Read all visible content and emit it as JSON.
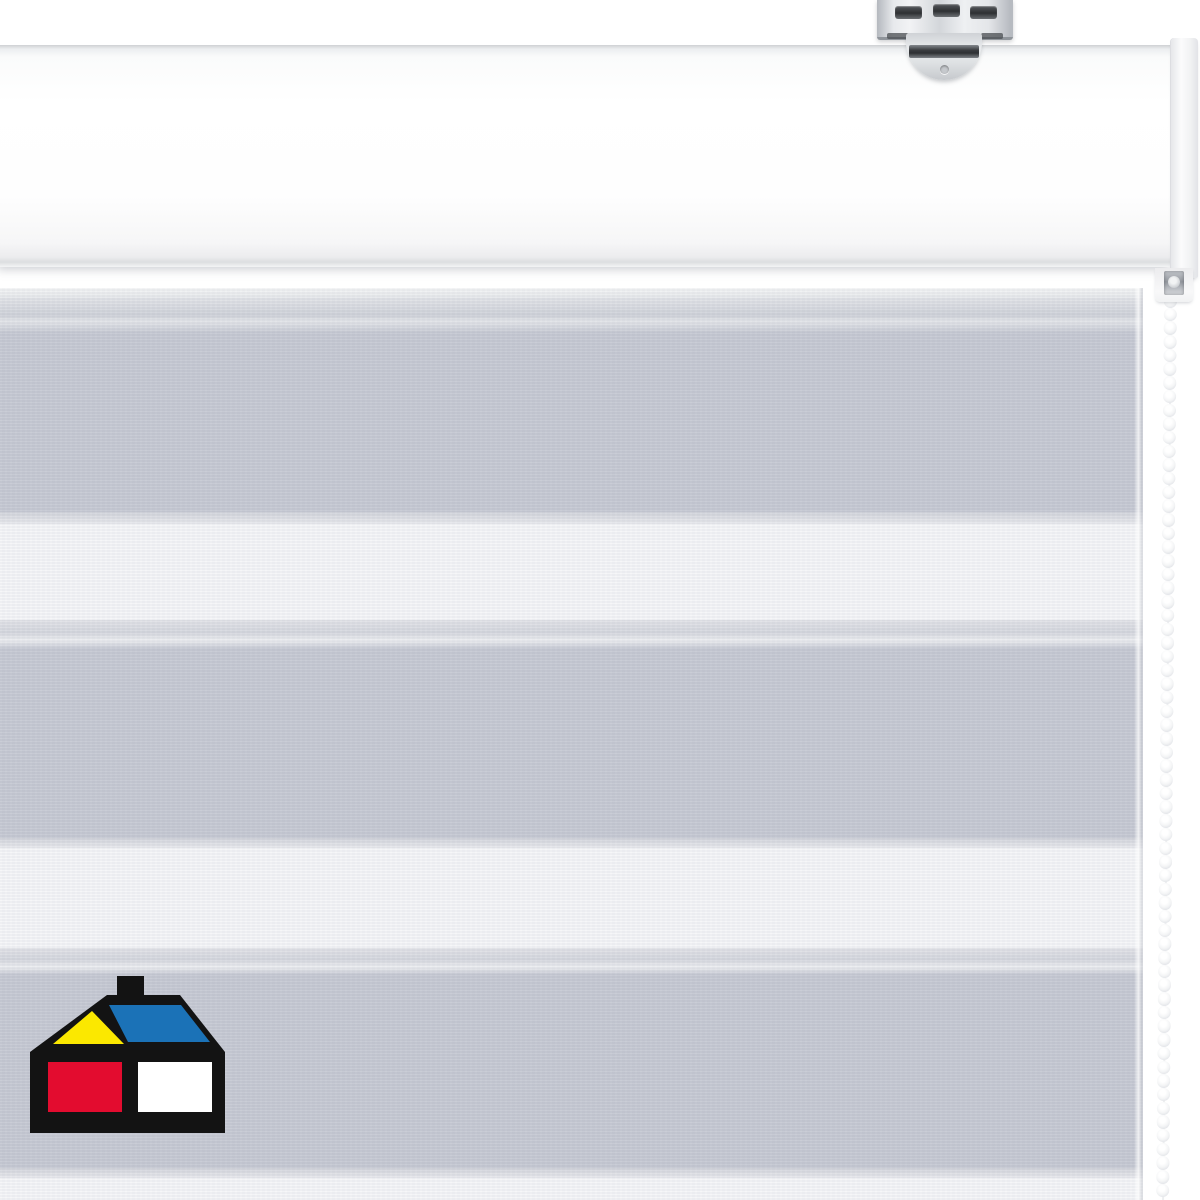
{
  "image": {
    "kind": "product-photo",
    "subject": "White day-night zebra roller blind: cassette headrail with metal ceiling bracket, alternating sheer white and grey fabric stripes, white bead chain on the right, house logo bottom-left",
    "width_px": 1200,
    "height_px": 1200
  },
  "colors": {
    "wall": "#ffffff",
    "stripe_gray": "#c6c9d3",
    "stripe_white": "#f5f6f8",
    "edge_light": "#e9eaee",
    "headrail_face": "#fdfdfd",
    "headrail_bottom": "#dcdee0",
    "endcap": "#f4f5f6",
    "metal_light": "#eef0f2",
    "metal_mid": "#c6cacf",
    "metal_dark": "#3a3d41",
    "chain_bead": "#ffffff",
    "chain_rim": "#d3d5da",
    "logo_black": "#131313",
    "logo_yellow": "#fbe800",
    "logo_blue": "#1b72b7",
    "logo_red": "#e30c2f",
    "logo_white": "#ffffff"
  },
  "blind": {
    "fabric_top": 288,
    "stripes": [
      {
        "kind": "top-edge",
        "top": 288,
        "height": 10
      },
      {
        "kind": "roll",
        "top": 298,
        "height": 34
      },
      {
        "kind": "gray",
        "top": 332,
        "height": 180
      },
      {
        "kind": "edge",
        "top": 512,
        "height": 12
      },
      {
        "kind": "white",
        "top": 524,
        "height": 96
      },
      {
        "kind": "lead",
        "top": 620,
        "height": 28
      },
      {
        "kind": "gray",
        "top": 648,
        "height": 190
      },
      {
        "kind": "edge",
        "top": 838,
        "height": 10
      },
      {
        "kind": "white",
        "top": 848,
        "height": 100
      },
      {
        "kind": "lead",
        "top": 948,
        "height": 26
      },
      {
        "kind": "gray",
        "top": 974,
        "height": 194
      },
      {
        "kind": "edge",
        "top": 1168,
        "height": 10
      },
      {
        "kind": "white",
        "top": 1178,
        "height": 22
      }
    ],
    "chain": {
      "bead_count": 66,
      "bead_size_px": 13.5,
      "bead_gap_px": 0.2,
      "tilt_deg": 0.5
    }
  },
  "logo": {
    "shapes": [
      "chimney",
      "house-outline",
      "yellow-gable",
      "blue-roof",
      "red-front-wall",
      "white-side-wall"
    ]
  }
}
